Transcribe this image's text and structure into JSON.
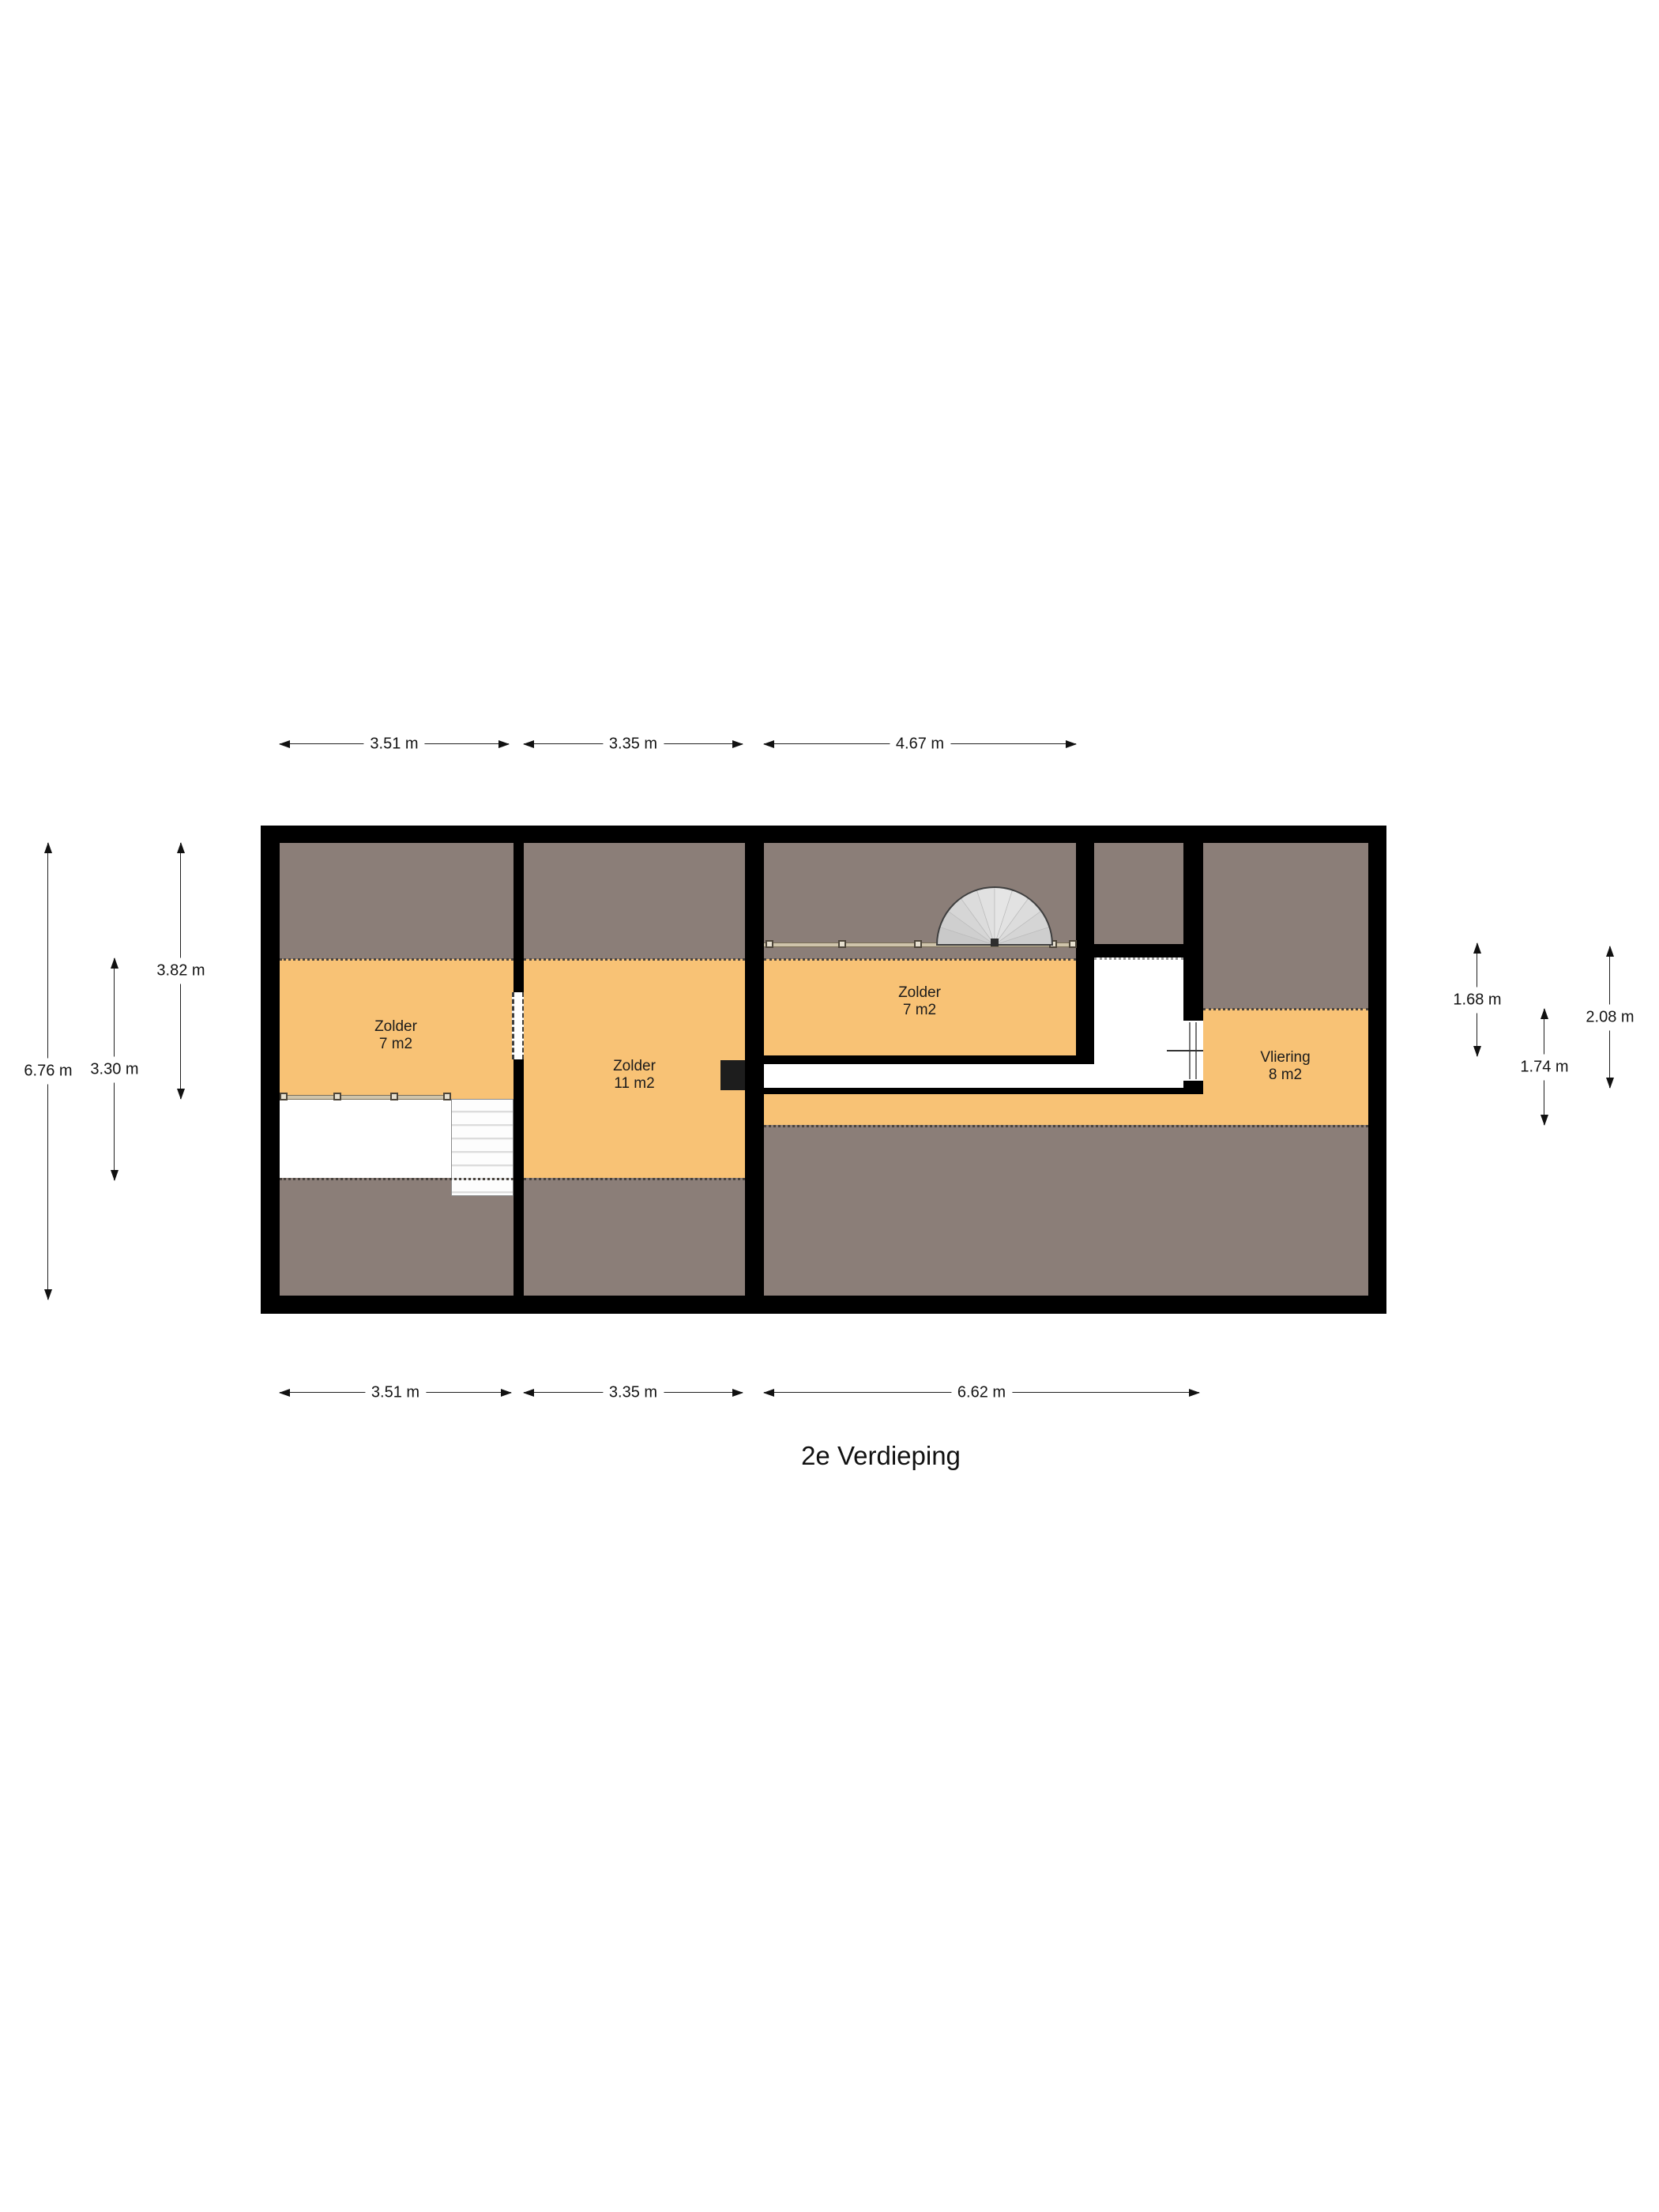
{
  "title": "2e Verdieping",
  "rooms": [
    {
      "name": "Zolder",
      "area": "7 m2"
    },
    {
      "name": "Zolder",
      "area": "11 m2"
    },
    {
      "name": "Zolder",
      "area": "7 m2"
    },
    {
      "name": "Vliering",
      "area": "8 m2"
    }
  ],
  "dimensions": {
    "top": [
      {
        "label": "3.51 m"
      },
      {
        "label": "3.35 m"
      },
      {
        "label": "4.67 m"
      }
    ],
    "bottom": [
      {
        "label": "3.51 m"
      },
      {
        "label": "3.35 m"
      },
      {
        "label": "6.62 m"
      }
    ],
    "left": [
      {
        "label": "6.76 m"
      },
      {
        "label": "3.82 m"
      },
      {
        "label": "3.30 m"
      }
    ],
    "right": [
      {
        "label": "1.68 m"
      },
      {
        "label": "2.08 m"
      },
      {
        "label": "1.74 m"
      }
    ]
  },
  "colors": {
    "floor": "#F8C275",
    "low_ceiling": "#8B7E78",
    "wall": "#000000",
    "stair_fill": "#D9D9D9"
  }
}
